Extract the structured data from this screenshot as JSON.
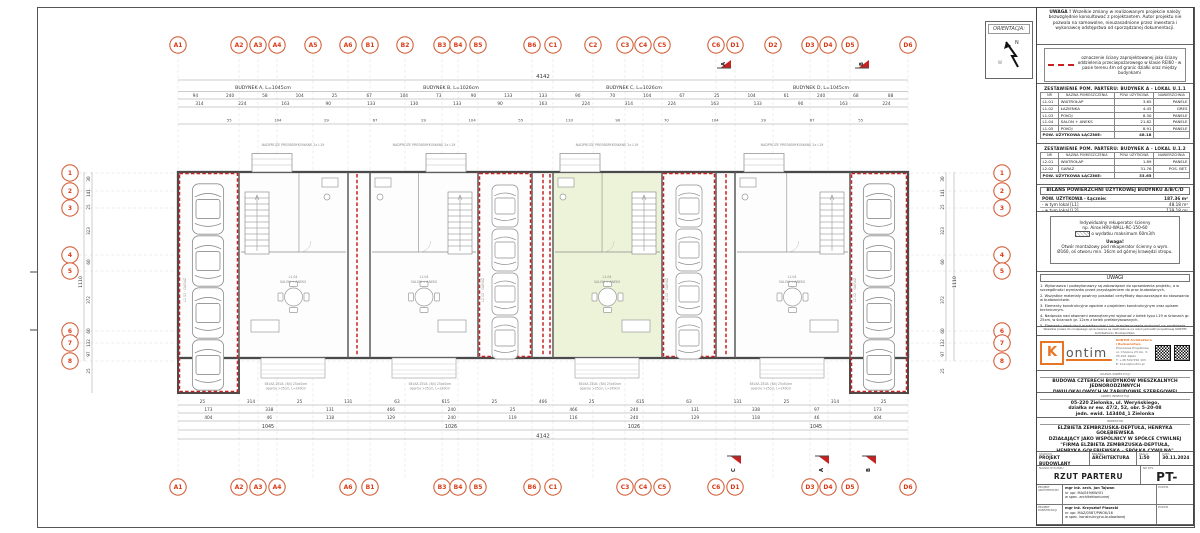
{
  "colors": {
    "fire_wall": "#c62222",
    "grid_bubble": "#d4603a",
    "grid_bubble_text": "#d93b16",
    "highlight_green": "#edf3d8",
    "kontim_orange": "#e87426"
  },
  "orientation": {
    "label": "ORIENTACJA:",
    "north": "N"
  },
  "uwaga_box": {
    "title": "UWAGA !",
    "text": "Wszelkie zmiany w realizowanym projekcie należy bezwzględnie konsultować z projektantem. Autor projektu nie pozwala na samowolne, nieuzasadnione przez inwestora i wykonawcę odstępstwa od sporządzanej dokumentacji."
  },
  "legend_box": {
    "text": "oznaczenie ściany zaprojektowanej jako ściany oddzielenia przeciwpożarowego w klasie REI60 - w pasie terenu 4m od granic działki oraz między budynkami"
  },
  "tables": [
    {
      "title": "ZESTAWIENIE POM. PARTERU:  BUDYNEK A - LOKAL U.1.1",
      "headers": [
        "NR",
        "NAZWA POMIESZCZENIA",
        "POW. UŻYTKOWA",
        "NAWIERZCHNIA"
      ],
      "rows": [
        [
          "L1.01",
          "WIATROŁAP",
          "3.65",
          "PANELE"
        ],
        [
          "L1.02",
          "ŁAZIENKA",
          "4.45",
          "GRES"
        ],
        [
          "L1.03",
          "POKÓJ",
          "8.30",
          "PANELE"
        ],
        [
          "L1.04",
          "SALON + ANEKS",
          "21.82",
          "PANELE"
        ],
        [
          "L1.05",
          "POKÓJ",
          "8.91",
          "PANELE"
        ]
      ],
      "footer_label": "POW. UŻYTKOWA ŁĄCZNIE:",
      "footer_value": "48.18"
    },
    {
      "title": "ZESTAWIENIE POM. PARTERU:  BUDYNEK A - LOKAL U.1.2",
      "headers": [
        "NR",
        "NAZWA POMIESZCZENIA",
        "POW. UŻYTKOWA",
        "NAWIERZCHNIA"
      ],
      "rows": [
        [
          "L2.01",
          "WIATROŁAP",
          "1.89",
          "PANELE"
        ],
        [
          "L2.02",
          "GARAŻ",
          "31.76",
          "POS. BET."
        ]
      ],
      "footer_label": "POW. UŻYTKOWA ŁĄCZNIE:",
      "footer_value": "33.65"
    }
  ],
  "bilans": {
    "title": "BILANS POWIERZCHNI UŻYTKOWEJ BUDYNKU A/B/C/D",
    "rows": [
      [
        "POW. UŻYTKOWA - Łącznie:",
        "187.36 m²"
      ],
      [
        "- w tym lokal [L1]",
        "48.18 m²"
      ],
      [
        "- w tym lokal [L2]",
        "139.18 m²"
      ]
    ]
  },
  "reku": {
    "line1": "Indywidualny rekuperator ścienny",
    "line2": "np. Airox HRU-WALL-RC-150-60",
    "line3": "o wydatku maksimum 60m3/h",
    "note_title": "Uwaga!",
    "note": "Otwór montażowy pod rekuperator ścienny o wym. Ø160, oś otworu min. 16cm od górnej krawędzi stropu."
  },
  "uwagi": {
    "title": "UWAGI",
    "items": [
      "1. Wykonawca i podwykonawcy są zobowiązani do sprawdzenia projektu, a w szczególności wymiarów przed przystąpieniem do prac budowlanych.",
      "2. Wszystkie materiały powinny posiadać certyfikaty dopuszczające do stosowania w budownictwie.",
      "3. Elementy konstrukcyjne zgodnie z projektem konstrukcyjnym oraz opisem technicznym.",
      "4. Nadproża nad otworami wewnętrznymi wykonać z belek typu L19 w ścianach gr. 25cm, w ścianach gr. 12cm z belek prefabrykowanych.",
      "5. Elementy wentylacji grawitacyjnej i ich rozmieszczenie wykonać na podstawie schematów instalacji sanitarnych wg projektu technicznego."
    ]
  },
  "copyright1": "Wszelkie prawa do niniejszego opracowania są zastrzeżone na rzecz jednostki projektowej KONTIM Architektura i Budownictwo.",
  "copyright2": "Kopiowanie i udostępnianie osobom trzecim bez zgody autora zabronione.",
  "firm": {
    "logo_k": "K",
    "logo_rest": "ontim",
    "name": "KONTIM Architektura i Budownictwo",
    "line1": "Pracownia Projektowa",
    "line2": "ul. Chopina 23 lok. 3, 05-091 Ząbki",
    "line3": "T: +48 509 556 103",
    "line4": "E: biuro@kontim.pl"
  },
  "project": {
    "nazwa_label": "NAZWA INWESTYCJI",
    "nazwa1": "BUDOWA CZTERECH BUDYNKÓW MIESZKALNYCH JEDNORODZINNYCH",
    "nazwa2": "DWULOKALOWYCH W ZABUDOWIE SZEREGOWEJ",
    "adres_label": "ADRES INWESTYCJI",
    "adres1": "05-220 Zielonka, ul. Weryńskiego,",
    "adres2": "działka nr ew. 47/2, 52, obr. 5-20-08",
    "adres3": "jedn. ewid. 143404_1 Zielonka",
    "inwestor_label": "INWESTOR",
    "inwestor1": "ELŻBIETA ZEMBRZUSKA-DEPTUŁA, HENRYKA GOŁĘBIEWSKA",
    "inwestor2": "DZIAŁAJĄCY JAKO WSPÓLNICY W SPÓŁCE CYWILNEJ",
    "inwestor3": "\"FIRMA ELŻBIETA ZEMBRZUSKA-DEPTUŁA,",
    "inwestor4": "HENRYKA GOŁĘBIEWSKA - SPÓŁKA CYWILNA\"",
    "inwestor5": "05-250 Radzymin, ul. Letniskowa 9"
  },
  "titleblock": {
    "stadium_label": "STADIUM",
    "stadium": "PROJEKT BUDOWLANY",
    "branza_label": "BRANŻA",
    "branza": "ARCHITEKTURA",
    "skala_label": "SKALA",
    "skala": "1:50",
    "data_label": "DATA",
    "data": "30.11.2024",
    "rysunek_label": "NAZWA RYSUNKU",
    "rysunek": "RZUT PARTERU",
    "nr_label": "NR RYS.",
    "nr": "PT-A01",
    "podpis_label": "PODPIS",
    "designers": [
      {
        "role": "PROJEKT ARCHITEKTURY",
        "name": "mgr inż. arch. Jan Tajwan",
        "upr": "nr upr. MA/049/KW/01",
        "spec": "w spec. architektonicznej"
      },
      {
        "role": "PROJEKT KONSTRUKCJI",
        "name": "mgr inż. Krzysztof Piasecki",
        "upr": "nr upr. MAZ/0587/PWOK/16",
        "spec": "w spec. konstrukcyjno-budowlanej"
      }
    ]
  },
  "plan": {
    "top_total": "4142",
    "bottom_total": "4142",
    "side_total": "1110",
    "buildings": [
      {
        "label": "BUDYNEK A, L=1045cm",
        "cx": 263
      },
      {
        "label": "BUDYNEK B, L=1026cm",
        "cx": 451
      },
      {
        "label": "BUDYNEK C, L=1026cm",
        "cx": 634
      },
      {
        "label": "BUDYNEK D, L=1045cm",
        "cx": 821
      }
    ],
    "bottom_totals": [
      [
        "1045",
        268
      ],
      [
        "1026",
        451
      ],
      [
        "1026",
        634
      ],
      [
        "1045",
        816
      ]
    ],
    "grid_top": [
      [
        "A1",
        178
      ],
      [
        "A2",
        239
      ],
      [
        "A3",
        258
      ],
      [
        "A4",
        277
      ],
      [
        "A5",
        313
      ],
      [
        "A6",
        348
      ],
      [
        "B1",
        370
      ],
      [
        "B2",
        405
      ],
      [
        "B3",
        442
      ],
      [
        "B4",
        458
      ],
      [
        "B5",
        478
      ],
      [
        "B6",
        532
      ],
      [
        "C1",
        553
      ],
      [
        "C2",
        593
      ],
      [
        "C3",
        625
      ],
      [
        "C4",
        643
      ],
      [
        "C5",
        662
      ],
      [
        "C6",
        716
      ],
      [
        "D1",
        735
      ],
      [
        "D2",
        773
      ],
      [
        "D3",
        810
      ],
      [
        "D4",
        828
      ],
      [
        "D5",
        850
      ],
      [
        "D6",
        908
      ]
    ],
    "grid_bottom": [
      [
        "A1",
        178
      ],
      [
        "A2",
        239
      ],
      [
        "A3",
        258
      ],
      [
        "A4",
        277
      ],
      [
        "A6",
        348
      ],
      [
        "B1",
        370
      ],
      [
        "B3",
        442
      ],
      [
        "B4",
        458
      ],
      [
        "B5",
        478
      ],
      [
        "B6",
        532
      ],
      [
        "C1",
        553
      ],
      [
        "C3",
        625
      ],
      [
        "C4",
        643
      ],
      [
        "C5",
        662
      ],
      [
        "C6",
        716
      ],
      [
        "D1",
        735
      ],
      [
        "D3",
        810
      ],
      [
        "D4",
        828
      ],
      [
        "D5",
        850
      ],
      [
        "D6",
        908
      ]
    ],
    "grid_side": [
      [
        "1",
        173
      ],
      [
        "2",
        191
      ],
      [
        "3",
        208
      ],
      [
        "4",
        255
      ],
      [
        "5",
        271
      ],
      [
        "6",
        331
      ],
      [
        "7",
        343
      ],
      [
        "8",
        361
      ]
    ],
    "top_dims1": [
      "94",
      "240",
      "58",
      "104",
      "25",
      "67",
      "104",
      "73",
      "90",
      "133",
      "133",
      "90",
      "70",
      "104",
      "67",
      "25",
      "104",
      "61",
      "240",
      "68",
      "88"
    ],
    "top_dims2": [
      "314",
      "224",
      "163",
      "90",
      "133",
      "130",
      "133",
      "90",
      "163",
      "224",
      "314",
      "224",
      "163",
      "133",
      "90",
      "163",
      "224"
    ],
    "top_dims3": [
      "55",
      "104",
      "29",
      "67",
      "29",
      "104",
      "55",
      "133",
      "90",
      "70",
      "104",
      "29",
      "67",
      "55"
    ],
    "bot_dims1": [
      "25",
      "314",
      "25",
      "131",
      "63",
      "615",
      "25",
      "466",
      "25",
      "615",
      "63",
      "131",
      "25",
      "314",
      "25"
    ],
    "bot_dims2": [
      "173",
      "338",
      "131",
      "466",
      "240",
      "25",
      "466",
      "240",
      "131",
      "338",
      "97",
      "173"
    ],
    "bot_dims3": [
      "404",
      "46",
      "118",
      "129",
      "240",
      "119",
      "116",
      "240",
      "129",
      "118",
      "46",
      "404"
    ],
    "side_dims": [
      [
        "30",
        179
      ],
      [
        "141",
        193
      ],
      [
        "25",
        207
      ],
      [
        "323",
        231
      ],
      [
        "60",
        262
      ],
      [
        "372",
        300
      ],
      [
        "60",
        331
      ],
      [
        "132",
        343
      ],
      [
        "97",
        354
      ],
      [
        "25",
        371
      ]
    ],
    "lintel_label": "NADPROŻE PREFABRYKOWANE 2x L19",
    "lintel_xs": [
      293,
      424,
      607,
      792
    ],
    "belka_label1": "BELKA ŻELB. (B4) 25x40cm",
    "belka_label2": "oparcie >25cm, L=240cm",
    "belka_xs": [
      286,
      430,
      600,
      771
    ],
    "garage_label": "L2.02 · GARAŻ",
    "garage_label_xs": [
      186,
      484,
      668,
      856
    ],
    "room_label1": "L1.04",
    "room_label2": "SALON + ANEKS",
    "room_label_xs": [
      293,
      424,
      607,
      792
    ],
    "sections_top": [
      [
        "A",
        730
      ],
      [
        "B",
        868
      ]
    ],
    "sections_bottom": [
      [
        "C",
        740
      ],
      [
        "A",
        828
      ],
      [
        "B",
        875
      ]
    ]
  }
}
